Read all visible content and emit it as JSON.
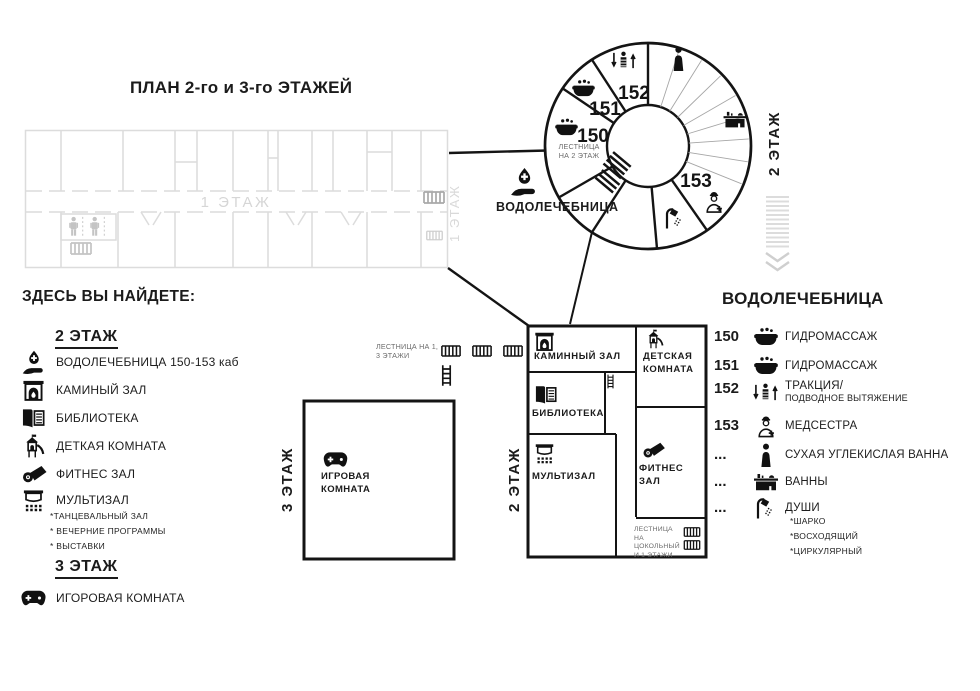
{
  "title": "ПЛАН 2-го и 3-го ЭТАЖЕЙ",
  "floor1": {
    "corridor_label": "1 ЭТАЖ",
    "side_label": "1 ЭТАЖ"
  },
  "circle": {
    "side_label": "2 ЭТАЖ",
    "stairs_label": "ЛЕСТНИЦА НА 2 ЭТАЖ",
    "entrance_label": "ВОДОЛЕЧЕБНИЦА",
    "entrance_icon": "hydrotherapy-icon",
    "stairs_icon": "stairs-hatch-icon",
    "rooms": [
      {
        "number": "150",
        "icon": "hydromassage-tub-icon"
      },
      {
        "number": "151",
        "icon": "hydromassage-tub-icon"
      },
      {
        "number": "152",
        "icon": "traction-icon"
      },
      {
        "number": "153",
        "icon": "nurse-icon"
      }
    ],
    "other_icons": [
      "dry-bath-icon",
      "bath-icon",
      "shower-icon"
    ]
  },
  "mid_stairs_label": "ЛЕСТНИЦА НА 1, 3 ЭТАЖИ",
  "floor3_box": {
    "side_label": "3 ЭТАЖ",
    "room": {
      "icon": "gamepad-icon",
      "label": "ИГРОВАЯ КОМНАТА"
    }
  },
  "floor2_box": {
    "side_label": "2 ЭТАЖ",
    "rooms": {
      "fireplace": {
        "icon": "fireplace-icon",
        "label": "КАМИННЫЙ ЗАЛ"
      },
      "kids": {
        "icon": "kids-room-icon",
        "label": "ДЕТСКАЯ КОМНАТА"
      },
      "library": {
        "icon": "library-icon",
        "label": "БИБЛИОТЕКА"
      },
      "multihall": {
        "icon": "multihall-icon",
        "label": "МУЛЬТИЗАЛ"
      },
      "fitness": {
        "icon": "fitness-icon",
        "label": "ФИТНЕС ЗАЛ"
      }
    },
    "stairs_label": "ЛЕСТНИЦА НА ЦОКОЛЬНЫЙ И 1 ЭТАЖИ"
  },
  "legend": {
    "heading": "ЗДЕСЬ ВЫ НАЙДЕТЕ:",
    "floor2_title": "2 ЭТАЖ",
    "floor2_items": [
      {
        "icon": "hydrotherapy-icon",
        "label": "ВОДОЛЕЧЕБНИЦА 150-153 каб"
      },
      {
        "icon": "fireplace-icon",
        "label": "КАМИНЫЙ ЗАЛ"
      },
      {
        "icon": "library-icon",
        "label": "БИБЛИОТЕКА"
      },
      {
        "icon": "kids-room-icon",
        "label": "ДЕТКАЯ КОМНАТА"
      },
      {
        "icon": "fitness-icon",
        "label": "ФИТНЕС ЗАЛ"
      },
      {
        "icon": "multihall-icon",
        "label": "МУЛЬТИЗАЛ"
      }
    ],
    "multihall_notes": [
      "*ТАНЦЕВАЛЬНЫЙ ЗАЛ",
      "* ВЕЧЕРНИЕ ПРОГРАММЫ",
      "* ВЫСТАВКИ"
    ],
    "floor3_title": "3 ЭТАЖ",
    "floor3_items": [
      {
        "icon": "gamepad-icon",
        "label": "ИГОРОВАЯ КОМНАТА"
      }
    ]
  },
  "hydro_legend": {
    "heading": "ВОДОЛЕЧЕБНИЦА",
    "items": [
      {
        "number": "150",
        "icon": "hydromassage-tub-icon",
        "label": "ГИДРОМАССАЖ"
      },
      {
        "number": "151",
        "icon": "hydromassage-tub-icon",
        "label": "ГИДРОМАССАЖ"
      },
      {
        "number": "152",
        "icon": "traction-icon",
        "label": "ТРАКЦИЯ/",
        "sublabel": "ПОДВОДНОЕ ВЫТЯЖЕНИЕ"
      },
      {
        "number": "153",
        "icon": "nurse-icon",
        "label": "МЕДСЕСТРА"
      },
      {
        "number": "...",
        "icon": "dry-bath-icon",
        "label": "СУХАЯ УГЛЕКИСЛАЯ ВАННА"
      },
      {
        "number": "...",
        "icon": "bath-icon",
        "label": "ВАННЫ"
      },
      {
        "number": "...",
        "icon": "shower-icon",
        "label": "ДУШИ"
      }
    ],
    "shower_notes": [
      "*ШАРКО",
      "*ВОСХОДЯЩИЙ",
      "*ЦИРКУЛЯРНЫЙ"
    ]
  },
  "colors": {
    "ink": "#111111",
    "faded_plan": "#dcdcdc",
    "gray_label": "#6b6b6b",
    "thin_line": "#a6a6a6"
  }
}
